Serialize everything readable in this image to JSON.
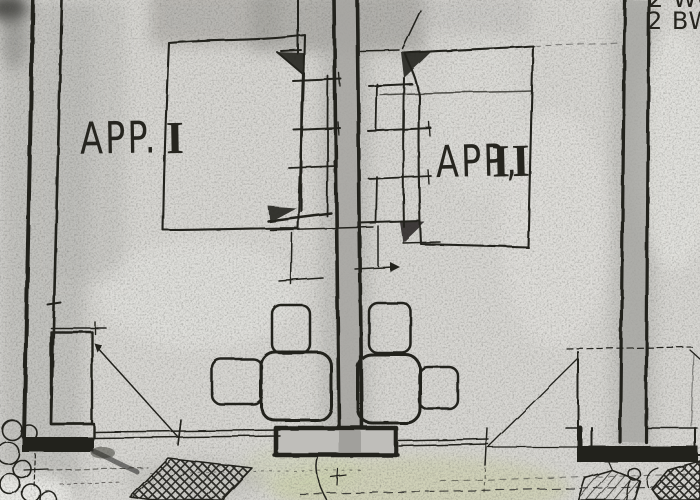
{
  "title": "Hand-drawn apartment floor plan sketch",
  "labels": {
    "apartment1": {
      "prefix": "APP.",
      "numeral": "I"
    },
    "apartment2": {
      "prefix": "APP,",
      "numeral": "II"
    }
  },
  "corner_note": {
    "line1": "2 WC",
    "line2": "2 BW"
  },
  "colors": {
    "paper": "#d8d7d3",
    "ink": "#23221e",
    "wall_shade": "#a6a5a1",
    "stain_green": "#c9cd9f"
  }
}
